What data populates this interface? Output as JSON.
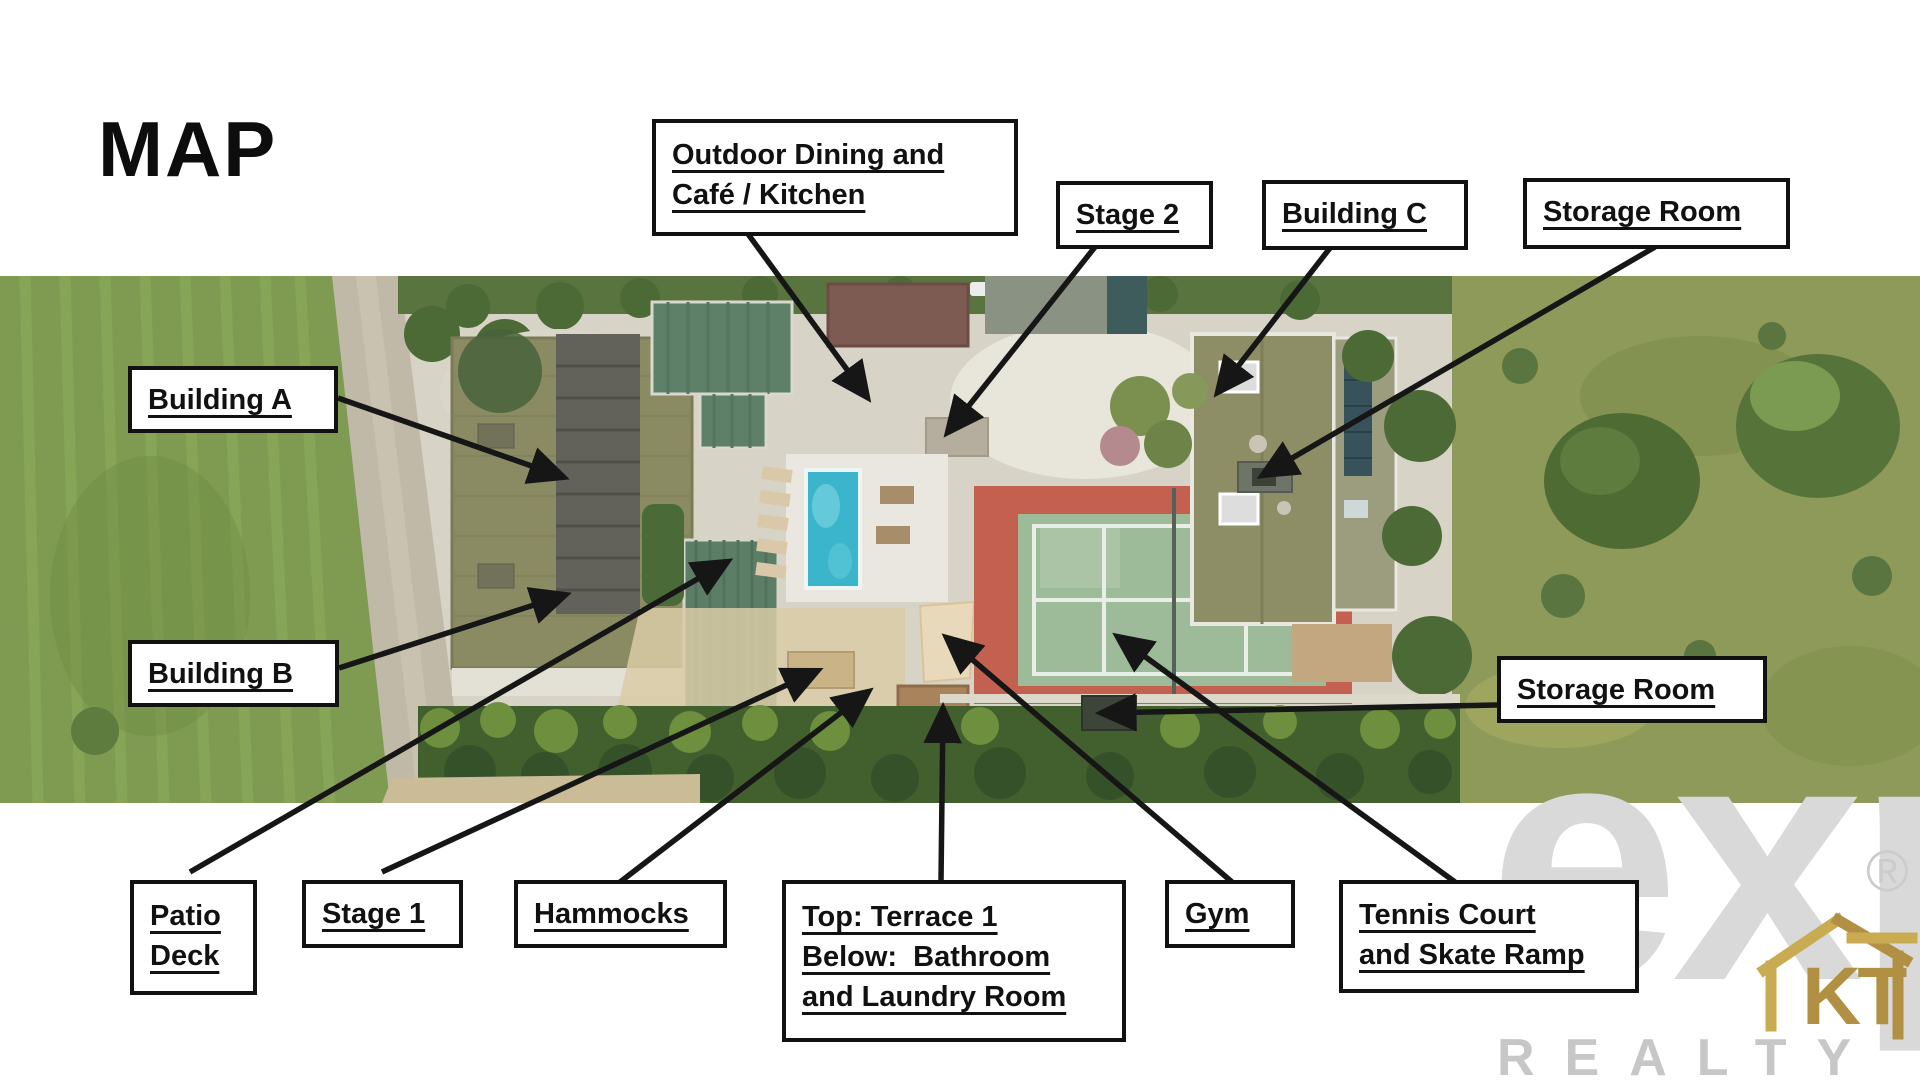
{
  "title": "MAP",
  "callouts": {
    "outdoor_dining": {
      "line1": "Outdoor Dining and",
      "line2": "Café / Kitchen"
    },
    "stage2": {
      "line1": "Stage 2"
    },
    "building_c": {
      "line1": "Building C"
    },
    "storage_top": {
      "line1": "Storage Room"
    },
    "building_a": {
      "line1": "Building A"
    },
    "building_b": {
      "line1": "Building B"
    },
    "storage_right": {
      "line1": "Storage Room"
    },
    "patio_deck": {
      "line1": "Patio",
      "line2": "Deck"
    },
    "stage1": {
      "line1": "Stage 1"
    },
    "hammocks": {
      "line1": "Hammocks"
    },
    "terrace": {
      "line1": "Top: Terrace 1",
      "line2": "Below:  Bathroom",
      "line3": "and Laundry Room"
    },
    "gym": {
      "line1": "Gym"
    },
    "tennis": {
      "line1": "Tennis Court",
      "line2": "and Skate Ramp"
    }
  },
  "logo": {
    "brand": "exp",
    "registered": "®",
    "subtitle": "REALTY",
    "monogram": "KT"
  },
  "colors": {
    "label_border": "#111111",
    "arrow": "#161616",
    "field_green": "#7e9b51",
    "meadow_green": "#8d9a59",
    "pool_blue": "#3ab5cb",
    "court_green": "#9dbb98",
    "court_red": "#c4604f",
    "roof_olive": "#8b8b63",
    "roof_teal": "#5d7e66",
    "logo_gray": "#d9d9d9",
    "logo_gold": "#b19043"
  }
}
